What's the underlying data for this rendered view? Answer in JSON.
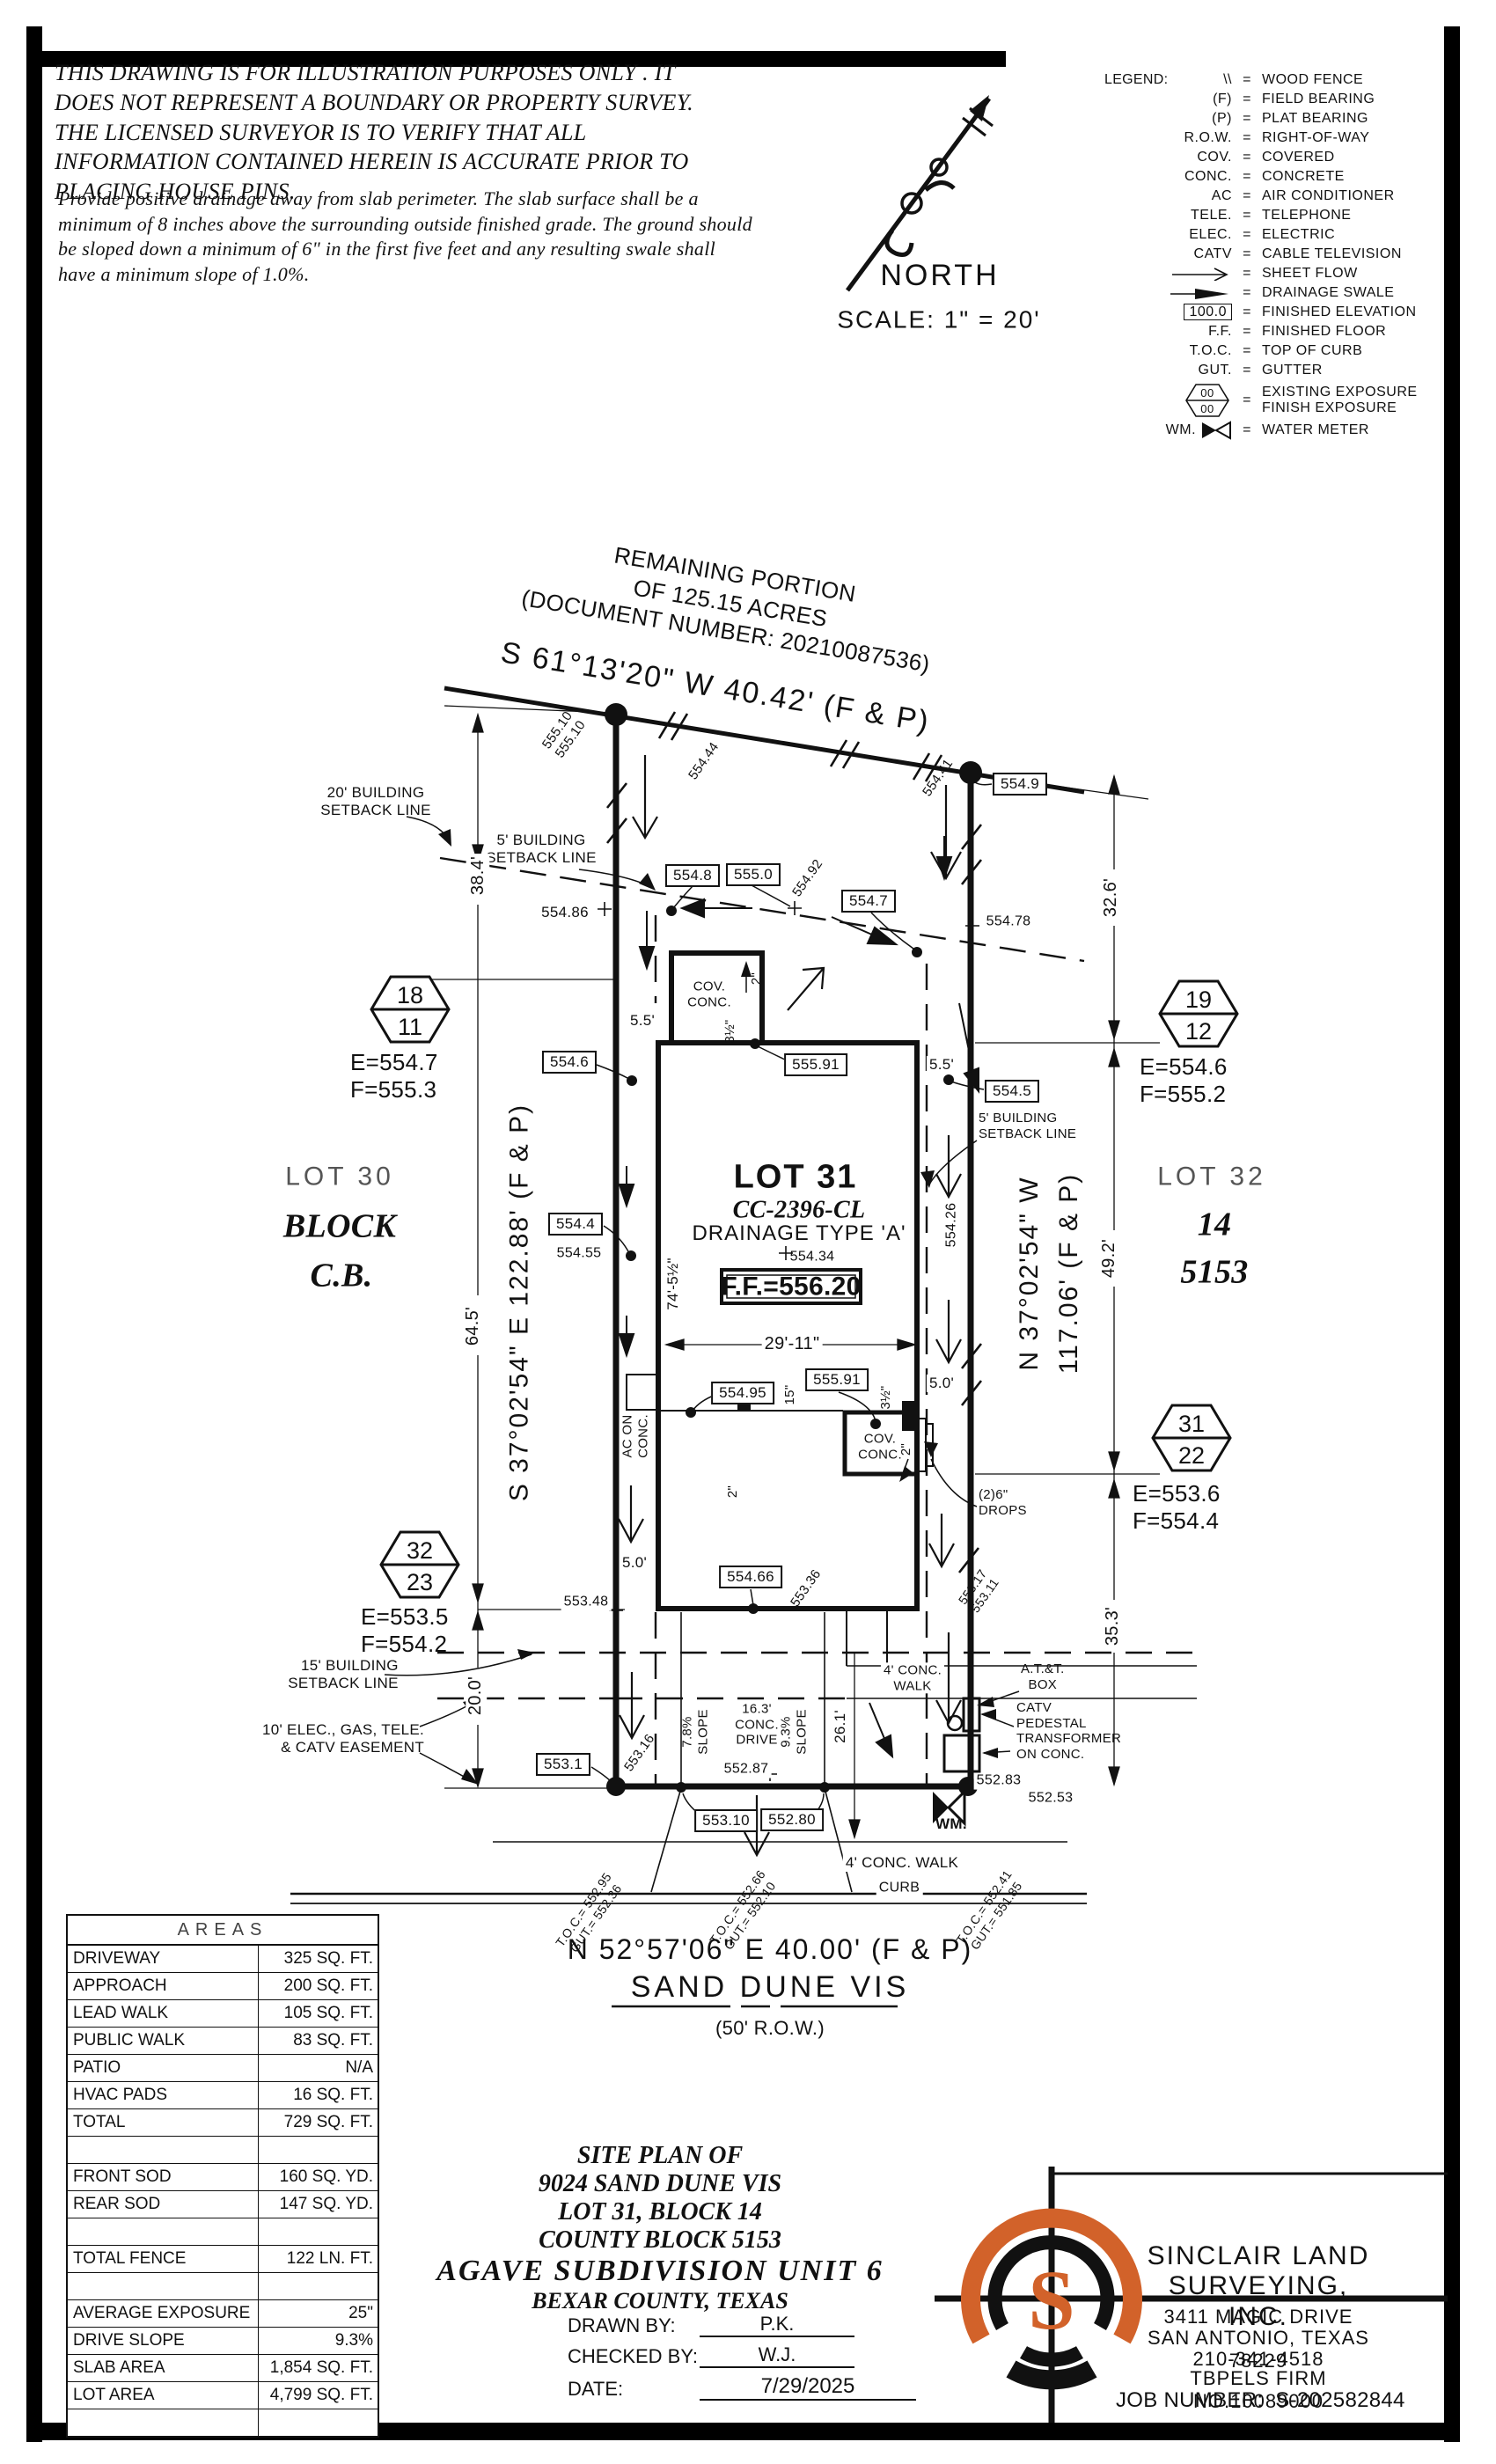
{
  "disclaimer": {
    "para1": "THIS DRAWING IS FOR ILLUSTRATION PURPOSES ONLY . IT DOES NOT REPRESENT A BOUNDARY OR PROPERTY SURVEY. THE LICENSED SURVEYOR IS TO VERIFY THAT ALL INFORMATION CONTAINED HEREIN IS ACCURATE PRIOR TO PLACING HOUSE PINS.",
    "para2": "Provide positive drainage away from slab perimeter. The slab surface shall be a minimum of 8 inches above the surrounding outside finished grade. The ground should be sloped down a minimum of 6\" in the first five feet and any resulting swale shall have a minimum slope of 1.0%."
  },
  "compass": {
    "north_label": "NORTH",
    "scale_label": "SCALE:  1\" = 20'"
  },
  "legend": {
    "title": "LEGEND:",
    "eq": "=",
    "items": [
      {
        "sym": "\\\\",
        "desc": "WOOD FENCE"
      },
      {
        "sym": "(F)",
        "desc": "FIELD BEARING"
      },
      {
        "sym": "(P)",
        "desc": "PLAT BEARING"
      },
      {
        "sym": "R.O.W.",
        "desc": "RIGHT-OF-WAY"
      },
      {
        "sym": "COV.",
        "desc": "COVERED"
      },
      {
        "sym": "CONC.",
        "desc": "CONCRETE"
      },
      {
        "sym": "AC",
        "desc": "AIR CONDITIONER"
      },
      {
        "sym": "TELE.",
        "desc": "TELEPHONE"
      },
      {
        "sym": "ELEC.",
        "desc": "ELECTRIC"
      },
      {
        "sym": "CATV",
        "desc": "CABLE TELEVISION"
      },
      {
        "icon": "sheet-flow-arrow",
        "desc": "SHEET FLOW"
      },
      {
        "icon": "drainage-swale-arrow",
        "desc": "DRAINAGE SWALE"
      },
      {
        "sym": "100.0",
        "desc": "FINISHED ELEVATION"
      },
      {
        "sym": "F.F.",
        "desc": "FINISHED FLOOR"
      },
      {
        "sym": "T.O.C.",
        "desc": "TOP OF CURB"
      },
      {
        "sym": "GUT.",
        "desc": "GUTTER"
      },
      {
        "icon": "exposure-hexagon",
        "top": "00",
        "bottom": "00",
        "desc": "EXISTING EXPOSURE\nFINISH EXPOSURE"
      },
      {
        "sym": "WM.",
        "icon": "water-meter-bowtie",
        "desc": "WATER METER"
      }
    ]
  },
  "plat": {
    "remaining_portion": "REMAINING PORTION\nOF 125.15 ACRES\n(DOCUMENT NUMBER:  20210087536)",
    "bearing_top": "S 61°13'20\" W 40.42' (F & P)",
    "bearing_left": "S 37°02'54\" E 122.88' (F & P)",
    "bearing_right": "N 37°02'54\" W\n117.06' (F & P)",
    "bearing_bottom": "N 52°57'06\" E 40.00' (F & P)",
    "street": "SAND DUNE VIS",
    "row": "(50' R.O.W.)",
    "curb": "CURB",
    "lot30": "LOT 30",
    "block30": "BLOCK",
    "cb30": "C.B.",
    "lot31": "LOT 31",
    "plan_code": "CC-2396-CL",
    "drainage": "DRAINAGE TYPE 'A'",
    "ff": "F.F.=556.20",
    "s55434": "554.34",
    "lot32": "LOT 32",
    "block32": "14",
    "cb32": "5153",
    "sb20": "20' BUILDING\nSETBACK LINE",
    "sb5l": "5' BUILDING\nSETBACK LINE",
    "sb5r": "5' BUILDING\nSETBACK LINE",
    "sb15": "15' BUILDING\nSETBACK LINE",
    "easement": "10' ELEC., GAS, TELE.\n& CATV EASEMENT",
    "cov_top": "COV.\nCONC.",
    "cov_rear": "COV.\nCONC.",
    "ac": "AC ON\nCONC.",
    "drops": "(2)6\"\nDROPS",
    "att": "A.T.&T.\nBOX",
    "catv": "CATV\nPEDESTAL\nTRANSFORMER\nON CONC.",
    "wm": "WM.",
    "walk_inner": "4' CONC.\nWALK",
    "walk_street": "4' CONC. WALK",
    "drive": "16.3'\nCONC.\nDRIVE",
    "slope_l": "7.8%\nSLOPE",
    "slope_r": "9.3%\nSLOPE",
    "d384": "38.4'",
    "d645": "64.5'",
    "d200": "20.0'",
    "d326": "32.6'",
    "d492": "49.2'",
    "d353": "35.3'",
    "d55l": "5.5'",
    "d55r": "5.5'",
    "d50l": "5.0'",
    "d50r": "5.0'",
    "d2911": "29'-11\"",
    "d74": "74'-5½\"",
    "d261": "26.1'",
    "d15": "15\"",
    "d35a": "3½\"",
    "d35b": "3½\"",
    "d2a": "2\"",
    "d2b": "2\"",
    "d2c": "2\"",
    "b5548": "554.8",
    "b5550": "555.0",
    "b5547": "554.7",
    "b5549": "554.9",
    "b5546": "554.6",
    "b5545": "554.5",
    "b5544": "554.4",
    "b55495": "554.95",
    "b55591a": "555.91",
    "b55591b": "555.91",
    "b55466": "554.66",
    "b5531": "553.1",
    "b55310": "553.10",
    "b55280": "552.80",
    "s55510": "555.10\n555.10",
    "s55444": "554.44",
    "s55441": "554.41",
    "s55486": "554.86",
    "s55492": "554.92",
    "s55478": "554.78",
    "s55426": "554.26",
    "s55455": "554.55",
    "s55348": "553.48",
    "s55316": "553.16",
    "s55336": "553.36",
    "s55317": "553.17\n553.11",
    "s55287": "552.87",
    "s55283": "552.83",
    "s55253": "552.53",
    "toc1": "T.O.C.= 552.95\nGUT.= 552.36",
    "toc2": "T.O.C.= 552.66\nGUT.= 552.10",
    "toc3": "T.O.C.= 552.41\nGUT.= 551.85",
    "hex": [
      {
        "top": "18",
        "bottom": "11",
        "ef": "E=554.7\nF=555.3"
      },
      {
        "top": "19",
        "bottom": "12",
        "ef": "E=554.6\nF=555.2"
      },
      {
        "top": "31",
        "bottom": "22",
        "ef": "E=553.6\nF=554.4"
      },
      {
        "top": "32",
        "bottom": "23",
        "ef": "E=553.5\nF=554.2"
      }
    ]
  },
  "areas": {
    "title": "AREAS",
    "rows": [
      [
        "DRIVEWAY",
        "325 SQ. FT."
      ],
      [
        "APPROACH",
        "200 SQ. FT."
      ],
      [
        "LEAD WALK",
        "105 SQ. FT."
      ],
      [
        "PUBLIC WALK",
        "83 SQ. FT."
      ],
      [
        "PATIO",
        "N/A"
      ],
      [
        "HVAC PADS",
        "16 SQ. FT."
      ],
      [
        "TOTAL",
        "729 SQ. FT."
      ],
      [
        "",
        ""
      ],
      [
        "FRONT SOD",
        "160 SQ. YD."
      ],
      [
        "REAR SOD",
        "147 SQ. YD."
      ],
      [
        "",
        ""
      ],
      [
        "TOTAL FENCE",
        "122 LN. FT."
      ],
      [
        "",
        ""
      ],
      [
        "AVERAGE EXPOSURE",
        "25\""
      ],
      [
        "DRIVE SLOPE",
        "9.3%"
      ],
      [
        "SLAB AREA",
        "1,854 SQ. FT."
      ],
      [
        "LOT AREA",
        "4,799 SQ. FT."
      ],
      [
        "",
        ""
      ]
    ]
  },
  "title_block": {
    "lines": [
      "SITE PLAN OF",
      "9024 SAND DUNE VIS",
      "LOT 31, BLOCK 14",
      "COUNTY BLOCK 5153",
      "AGAVE SUBDIVISION UNIT 6",
      "BEXAR COUNTY, TEXAS"
    ],
    "drawn_label": "DRAWN BY:",
    "drawn": "P.K.",
    "checked_label": "CHECKED BY:",
    "checked": "W.J.",
    "date_label": "DATE:",
    "date": "7/29/2025"
  },
  "firm": {
    "name1": "SINCLAIR LAND",
    "name2": "SURVEYING, INC.",
    "addr1": "3411 MAGIC DRIVE",
    "addr2": "SAN ANTONIO, TEXAS 78229",
    "phone": "210-341-4518",
    "firm_no": "TBPELS FIRM NO.10089000",
    "job_label": "JOB NUMBER:",
    "job": "S-202582844",
    "accent_color": "#d2622a",
    "line_color": "#111111"
  }
}
